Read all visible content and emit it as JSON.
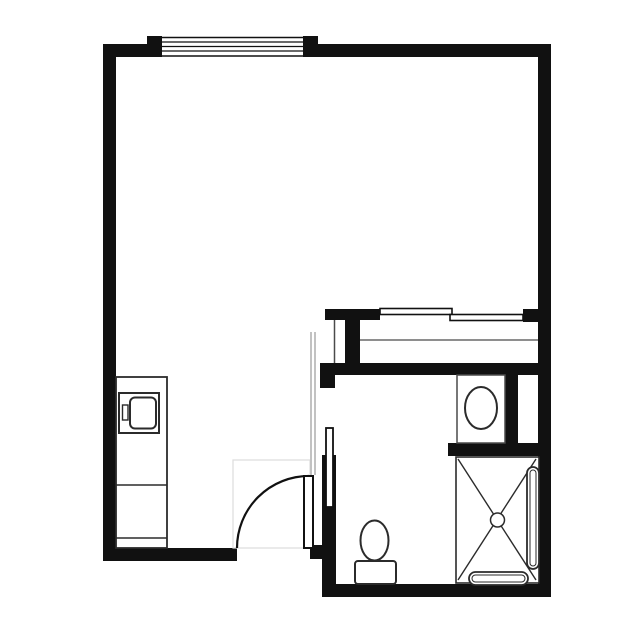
{
  "plan": {
    "label": "floor-plan",
    "canvas": {
      "width": 636,
      "height": 636
    },
    "palette": {
      "background": "#ffffff",
      "wall": "#111111",
      "fixture": "#2b2b2b",
      "thin": "#4a4a4a",
      "faint": "#9a9a9a",
      "zone": "#dcdcdc",
      "white": "#ffffff"
    },
    "layers": [
      {
        "name": "walls",
        "shapes": [
          {
            "n": "top-wall-left",
            "t": "rect",
            "x": 103,
            "y": 44,
            "w": 57,
            "h": 13,
            "f": "wall"
          },
          {
            "n": "top-wall-right",
            "t": "rect",
            "x": 318,
            "y": 44,
            "w": 233,
            "h": 13,
            "f": "wall"
          },
          {
            "n": "left-wall",
            "t": "rect",
            "x": 103,
            "y": 44,
            "w": 13,
            "h": 517,
            "f": "wall"
          },
          {
            "n": "right-wall",
            "t": "rect",
            "x": 538,
            "y": 44,
            "w": 13,
            "h": 553,
            "f": "wall"
          },
          {
            "n": "bottom-wall-left",
            "t": "rect",
            "x": 103,
            "y": 548,
            "w": 134,
            "h": 13,
            "f": "wall"
          },
          {
            "n": "entry-door-jamb-stub",
            "t": "rect",
            "x": 310,
            "y": 545,
            "w": 15,
            "h": 14,
            "f": "wall"
          },
          {
            "n": "bathroom-left-wall",
            "t": "rect",
            "x": 322,
            "y": 455,
            "w": 14,
            "h": 142,
            "f": "wall"
          },
          {
            "n": "bathroom-left-wall-stub",
            "t": "rect",
            "x": 320,
            "y": 363,
            "w": 15,
            "h": 25,
            "f": "wall"
          },
          {
            "n": "bathroom-top-wall",
            "t": "rect",
            "x": 320,
            "y": 363,
            "w": 231,
            "h": 12,
            "f": "wall"
          },
          {
            "n": "bathroom-bottom-wall",
            "t": "rect",
            "x": 322,
            "y": 584,
            "w": 229,
            "h": 13,
            "f": "wall"
          },
          {
            "n": "closet-front-wall",
            "t": "rect",
            "x": 325,
            "y": 309,
            "w": 55,
            "h": 11,
            "f": "wall"
          },
          {
            "n": "closet-right-wall-block",
            "t": "rect",
            "x": 523,
            "y": 309,
            "w": 15,
            "h": 13,
            "f": "wall"
          },
          {
            "n": "closet-pillar",
            "t": "rect",
            "x": 345,
            "y": 309,
            "w": 15,
            "h": 54,
            "f": "wall"
          },
          {
            "n": "vanity-side-wall",
            "t": "rect",
            "x": 505,
            "y": 375,
            "w": 13,
            "h": 68,
            "f": "wall"
          },
          {
            "n": "shower-divider-wall",
            "t": "rect",
            "x": 448,
            "y": 443,
            "w": 92,
            "h": 13,
            "f": "wall"
          }
        ]
      },
      {
        "name": "window",
        "shapes": [
          {
            "n": "window-opening",
            "t": "rect",
            "x": 160,
            "y": 36,
            "w": 145,
            "h": 21,
            "f": "white"
          },
          {
            "n": "window-jamb-left",
            "t": "rect",
            "x": 147,
            "y": 36,
            "w": 15,
            "h": 21,
            "f": "wall"
          },
          {
            "n": "window-jamb-right",
            "t": "rect",
            "x": 303,
            "y": 36,
            "w": 15,
            "h": 21,
            "f": "wall"
          },
          {
            "n": "window-frame-outer-line",
            "t": "line",
            "x1": 162,
            "y1": 37.5,
            "x2": 303,
            "y2": 37.5,
            "s": "wall",
            "sw": 1.4
          },
          {
            "n": "window-glazing-line-1",
            "t": "line",
            "x1": 162,
            "y1": 42,
            "x2": 303,
            "y2": 42,
            "s": "wall",
            "sw": 1.2
          },
          {
            "n": "window-glazing-line-2",
            "t": "line",
            "x1": 162,
            "y1": 46.5,
            "x2": 303,
            "y2": 46.5,
            "s": "wall",
            "sw": 1.2
          },
          {
            "n": "window-glazing-line-3",
            "t": "line",
            "x1": 162,
            "y1": 51,
            "x2": 303,
            "y2": 51,
            "s": "wall",
            "sw": 1.2
          },
          {
            "n": "window-frame-inner-line",
            "t": "line",
            "x1": 162,
            "y1": 56,
            "x2": 303,
            "y2": 56,
            "s": "wall",
            "sw": 1.6
          }
        ]
      },
      {
        "name": "closet",
        "shapes": [
          {
            "n": "closet-partition-line",
            "t": "line",
            "x1": 334.5,
            "y1": 320,
            "x2": 334.5,
            "y2": 363,
            "s": "thin",
            "sw": 1.5
          },
          {
            "n": "closet-shelf-line",
            "t": "line",
            "x1": 360,
            "y1": 340,
            "x2": 538,
            "y2": 340,
            "s": "thin",
            "sw": 1.3
          },
          {
            "n": "closet-sliding-door-rear",
            "t": "rect",
            "x": 380,
            "y": 308.5,
            "w": 72,
            "h": 6,
            "f": "white",
            "s": "wall",
            "sw": 1.6
          },
          {
            "n": "closet-sliding-door-front",
            "t": "rect",
            "x": 450,
            "y": 314.5,
            "w": 73,
            "h": 6,
            "f": "white",
            "s": "wall",
            "sw": 1.6
          }
        ]
      },
      {
        "name": "vestibule",
        "shapes": [
          {
            "n": "soffit-projection-line-left",
            "t": "line",
            "x1": 311,
            "y1": 332,
            "x2": 311,
            "y2": 475,
            "s": "faint",
            "sw": 1.2
          },
          {
            "n": "soffit-projection-line-right",
            "t": "line",
            "x1": 315,
            "y1": 332,
            "x2": 315,
            "y2": 475,
            "s": "faint",
            "sw": 1.2
          }
        ]
      },
      {
        "name": "kitchenette",
        "shapes": [
          {
            "n": "counter",
            "t": "rect",
            "x": 116,
            "y": 377,
            "w": 51,
            "h": 171,
            "f": "white",
            "s": "fixture",
            "sw": 1.8
          },
          {
            "n": "counter-divider-upper",
            "t": "line",
            "x1": 116,
            "y1": 485,
            "x2": 167,
            "y2": 485,
            "s": "fixture",
            "sw": 1.4
          },
          {
            "n": "counter-divider-lower",
            "t": "line",
            "x1": 116,
            "y1": 538,
            "x2": 167,
            "y2": 538,
            "s": "fixture",
            "sw": 1.4
          },
          {
            "n": "appliance-body",
            "t": "rect",
            "x": 119,
            "y": 393,
            "w": 40,
            "h": 40,
            "f": "white",
            "s": "fixture",
            "sw": 2
          },
          {
            "n": "appliance-door",
            "t": "rect",
            "x": 130,
            "y": 397.5,
            "w": 26,
            "h": 31,
            "rx": 5,
            "f": "white",
            "s": "fixture",
            "sw": 2
          },
          {
            "n": "appliance-handle",
            "t": "rect",
            "x": 122.5,
            "y": 405,
            "w": 5.5,
            "h": 15,
            "f": "white",
            "s": "fixture",
            "sw": 1.4
          }
        ]
      },
      {
        "name": "entry-door",
        "shapes": [
          {
            "n": "door-swing-zone",
            "t": "rect",
            "x": 233,
            "y": 460,
            "w": 77,
            "h": 88,
            "f": "none",
            "s": "zone",
            "sw": 1.2
          },
          {
            "n": "door-swing-arc",
            "t": "path",
            "d": "M 237 548 A 72 72 0 0 1 309 476",
            "f": "none",
            "s": "wall",
            "sw": 2.2
          },
          {
            "n": "door-leaf",
            "t": "rect",
            "x": 304,
            "y": 476,
            "w": 9,
            "h": 72,
            "f": "white",
            "s": "wall",
            "sw": 2
          }
        ]
      },
      {
        "name": "bathroom",
        "shapes": [
          {
            "n": "bathroom-door-leaf",
            "t": "rect",
            "x": 326,
            "y": 428,
            "w": 7,
            "h": 79,
            "f": "white",
            "s": "wall",
            "sw": 1.8
          },
          {
            "n": "vanity-counter",
            "t": "rect",
            "x": 457,
            "y": 375,
            "w": 48,
            "h": 68,
            "f": "white",
            "s": "thin",
            "sw": 1.5
          },
          {
            "n": "vanity-sink",
            "t": "ellipse",
            "cx": 481,
            "cy": 408,
            "rx": 16,
            "ry": 21,
            "f": "white",
            "s": "fixture",
            "sw": 2
          },
          {
            "n": "toilet-tank",
            "t": "rect",
            "x": 355,
            "y": 561,
            "w": 41,
            "h": 23,
            "rx": 3,
            "f": "white",
            "s": "fixture",
            "sw": 2
          },
          {
            "n": "toilet-bowl",
            "t": "ellipse",
            "cx": 374.5,
            "cy": 540.5,
            "rx": 14,
            "ry": 20,
            "f": "white",
            "s": "fixture",
            "sw": 2
          },
          {
            "n": "shower-pan",
            "t": "rect",
            "x": 456,
            "y": 457,
            "w": 83,
            "h": 126,
            "f": "white",
            "s": "fixture",
            "sw": 1.6
          },
          {
            "n": "shower-diagonal-1",
            "t": "line",
            "x1": 458,
            "y1": 459,
            "x2": 536,
            "y2": 580,
            "s": "fixture",
            "sw": 1.4
          },
          {
            "n": "shower-diagonal-2",
            "t": "line",
            "x1": 536,
            "y1": 459,
            "x2": 458,
            "y2": 580,
            "s": "fixture",
            "sw": 1.4
          },
          {
            "n": "shower-drain",
            "t": "circle",
            "cx": 497.5,
            "cy": 520,
            "r": 7,
            "f": "white",
            "s": "fixture",
            "sw": 1.5
          },
          {
            "n": "grab-bar-right-outer",
            "t": "rect",
            "x": 527,
            "y": 467,
            "w": 12,
            "h": 102,
            "rx": 6,
            "f": "white",
            "s": "fixture",
            "sw": 1.8
          },
          {
            "n": "grab-bar-right-inner",
            "t": "rect",
            "x": 530,
            "y": 470,
            "w": 6,
            "h": 96,
            "rx": 3,
            "f": "none",
            "s": "fixture",
            "sw": 1
          },
          {
            "n": "grab-bar-bottom-outer",
            "t": "rect",
            "x": 469,
            "y": 572,
            "w": 59,
            "h": 13,
            "rx": 6.5,
            "f": "white",
            "s": "fixture",
            "sw": 1.8
          },
          {
            "n": "grab-bar-bottom-inner",
            "t": "rect",
            "x": 472,
            "y": 575,
            "w": 53,
            "h": 7,
            "rx": 3.5,
            "f": "none",
            "s": "fixture",
            "sw": 1
          }
        ]
      }
    ]
  }
}
